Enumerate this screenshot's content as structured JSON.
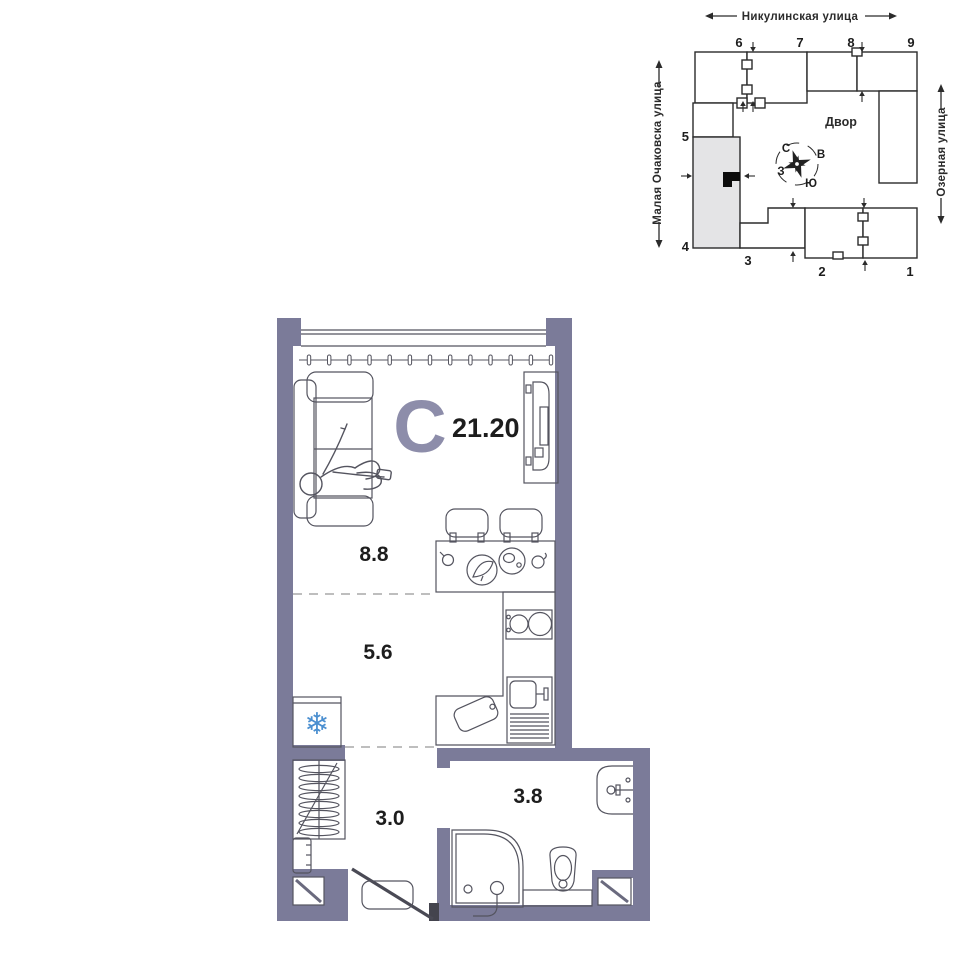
{
  "plan": {
    "type_letter": "С",
    "total_area": "21.20",
    "living": "8.8",
    "kitchen": "5.6",
    "hall": "3.0",
    "bathroom": "3.8"
  },
  "site": {
    "street_top": "Никулинская улица",
    "street_left": "Малая Очаковска улица",
    "street_right": "Озерная улица",
    "courtyard": "Двор",
    "n": "С",
    "e": "В",
    "s": "Ю",
    "w": "З",
    "b1": "1",
    "b2": "2",
    "b3": "3",
    "b4": "4",
    "b5": "5",
    "b6": "6",
    "b7": "7",
    "b8": "8",
    "b9": "9"
  },
  "icons": {
    "snowflake": "❄"
  },
  "colors": {
    "wall": "#7b7b99",
    "accent": "#8d8daa",
    "ink": "#1d1d1d",
    "furniture_line": "#54545f",
    "site_line": "#2b2b2b",
    "snowflake": "#4b8fd0",
    "highlight_building": "#e4e4e6"
  }
}
